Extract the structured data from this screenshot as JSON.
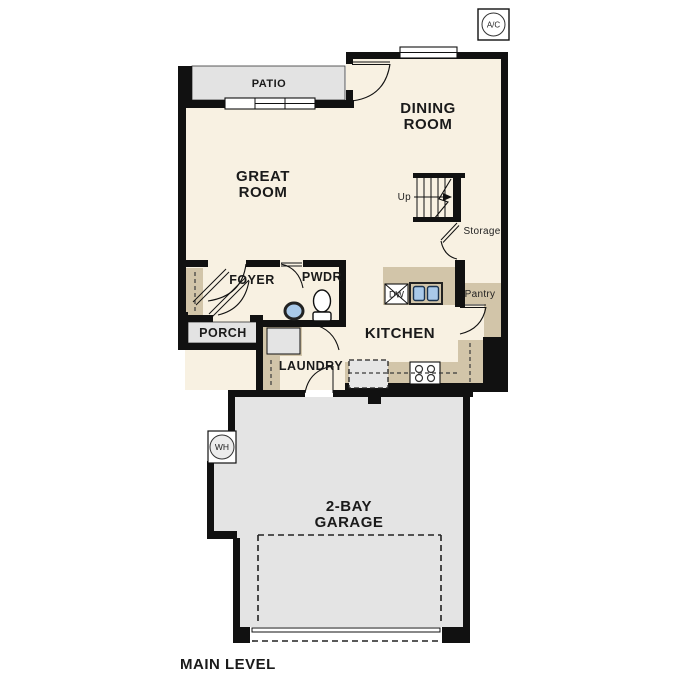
{
  "plan": {
    "footer_label": "MAIN LEVEL",
    "colors": {
      "floor_cream": "#f8f1e2",
      "outdoor_gray": "#e3e3e3",
      "garage_gray": "#e4e4e4",
      "counter_tan": "#d2c5a9",
      "sink_blue": "#a9c9e9",
      "wall_black": "#111111"
    },
    "rooms": {
      "great_room": {
        "line1": "GREAT",
        "line2": "ROOM"
      },
      "dining_room": {
        "line1": "DINING",
        "line2": "ROOM"
      },
      "kitchen": {
        "label": "KITCHEN"
      },
      "garage": {
        "line1": "2-BAY",
        "line2": "GARAGE"
      },
      "foyer": {
        "label": "FOYER"
      },
      "powder_room": {
        "label": "PWDR"
      },
      "porch": {
        "label": "PORCH"
      },
      "patio": {
        "label": "PATIO"
      },
      "laundry": {
        "label": "LAUNDRY"
      },
      "pantry": {
        "label": "Pantry"
      },
      "storage": {
        "label": "Storage"
      },
      "stairs": {
        "label": "Up"
      }
    },
    "fixtures": {
      "ac_unit": {
        "label": "A/C"
      },
      "water_heater": {
        "label": "WH"
      },
      "dishwasher": {
        "label": "DW"
      }
    }
  }
}
